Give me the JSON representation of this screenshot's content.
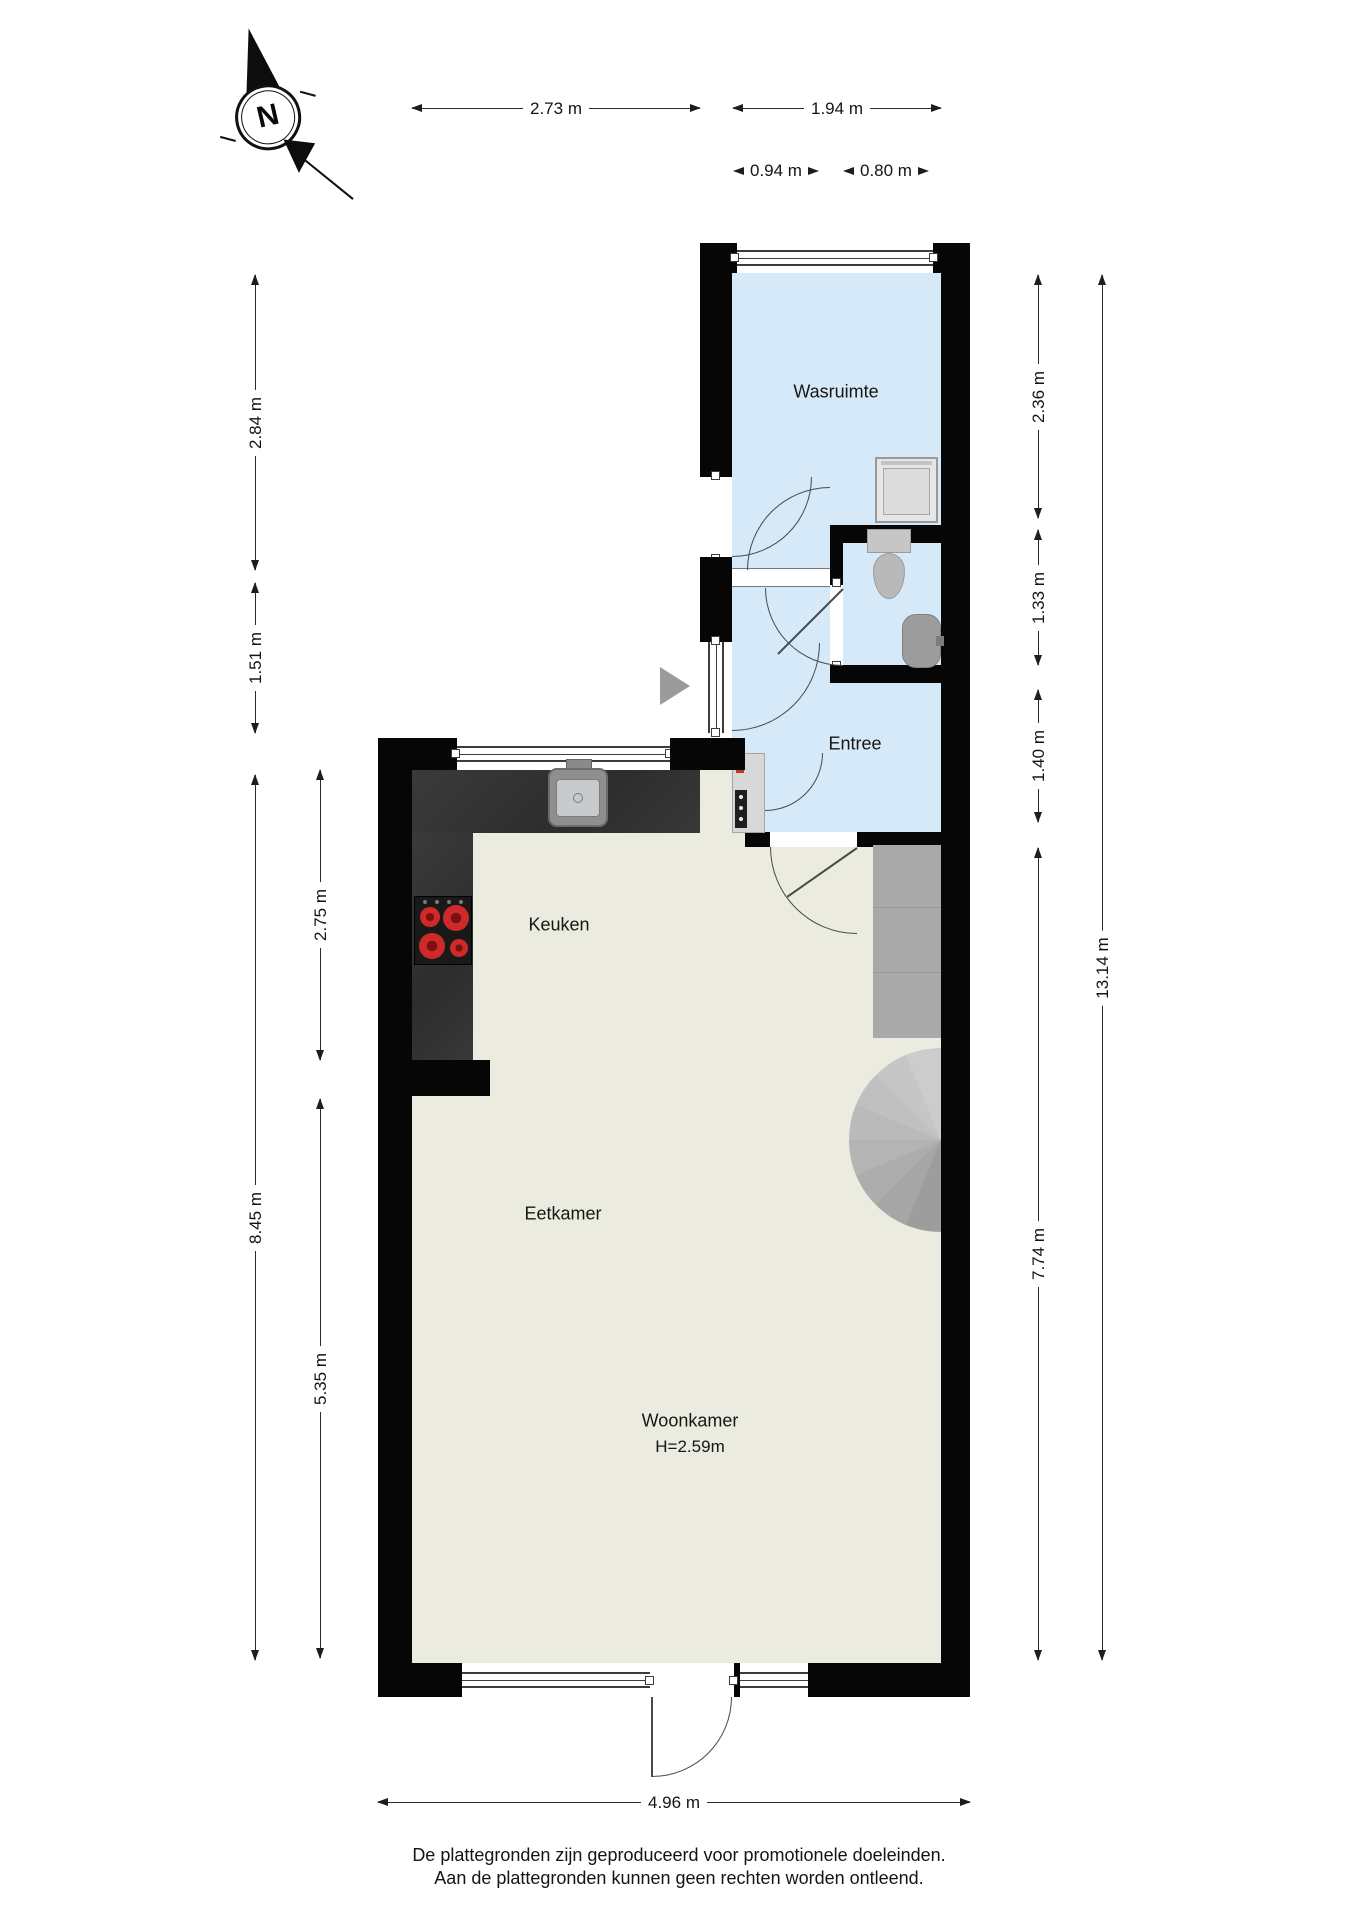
{
  "compass": {
    "north_label": "N"
  },
  "rooms": {
    "wasruimte": "Wasruimte",
    "entree": "Entree",
    "keuken": "Keuken",
    "eetkamer": "Eetkamer",
    "woonkamer": "Woonkamer",
    "woonkamer_height": "H=2.59m"
  },
  "dimensions": {
    "top_2_73": "2.73 m",
    "top_1_94": "1.94 m",
    "top_0_94": "0.94 m",
    "top_0_80": "0.80 m",
    "left_2_84": "2.84 m",
    "left_1_51": "1.51 m",
    "left_8_45": "8.45 m",
    "left_2_75": "2.75 m",
    "left_5_35": "5.35 m",
    "right_2_36": "2.36 m",
    "right_1_33": "1.33 m",
    "right_1_40": "1.40 m",
    "right_7_74": "7.74 m",
    "right_13_14": "13.14 m",
    "bottom_4_96": "4.96 m"
  },
  "footer": {
    "line1": "De plattegronden zijn geproduceerd voor promotionele doeleinden.",
    "line2": "Aan de plattegronden kunnen geen rechten worden ontleend."
  },
  "colors": {
    "wall": "#060606",
    "wet_room_floor": "#d5e9f9",
    "living_floor": "#ecebdf",
    "counter": "#343434",
    "fixture_grey": "#a9a9a9",
    "burner_red": "#cf2a2a",
    "dimension_line": "#2c2c2c"
  }
}
